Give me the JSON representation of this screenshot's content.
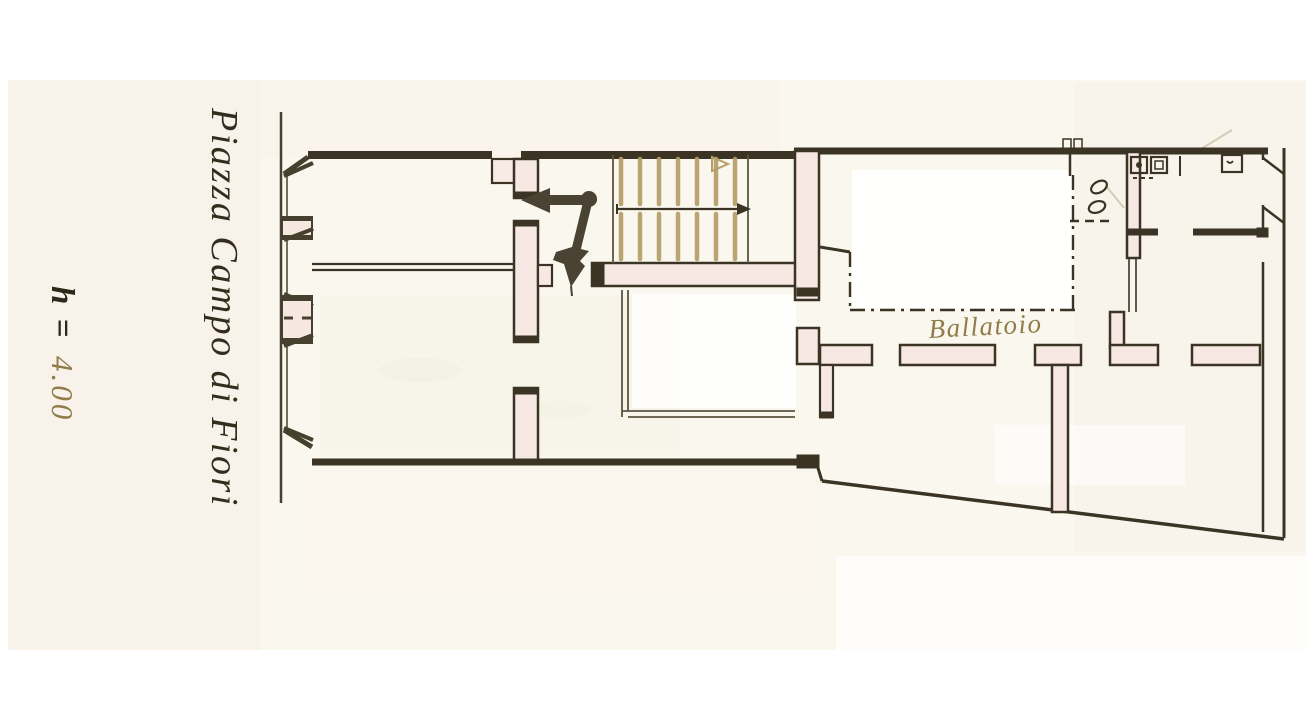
{
  "labels": {
    "street": "Piazza Campo di Fiori",
    "height_prefix": "h =",
    "height_value": "4.00",
    "balcony": "Ballatoio"
  },
  "plan": {
    "staircase": {
      "flights": 2,
      "treads_per_flight": 7,
      "direction_arrow": "right"
    },
    "facade_window_bays": 3
  },
  "colors": {
    "paper": "#faf7ee",
    "ink": "#3b3425",
    "wall_cavity": "#f7e8e3",
    "stair_tread": "#b59d67",
    "handwriting_dark": "#2e2818",
    "handwriting_olive": "#8f7c49",
    "arrow": "#4a4232"
  }
}
